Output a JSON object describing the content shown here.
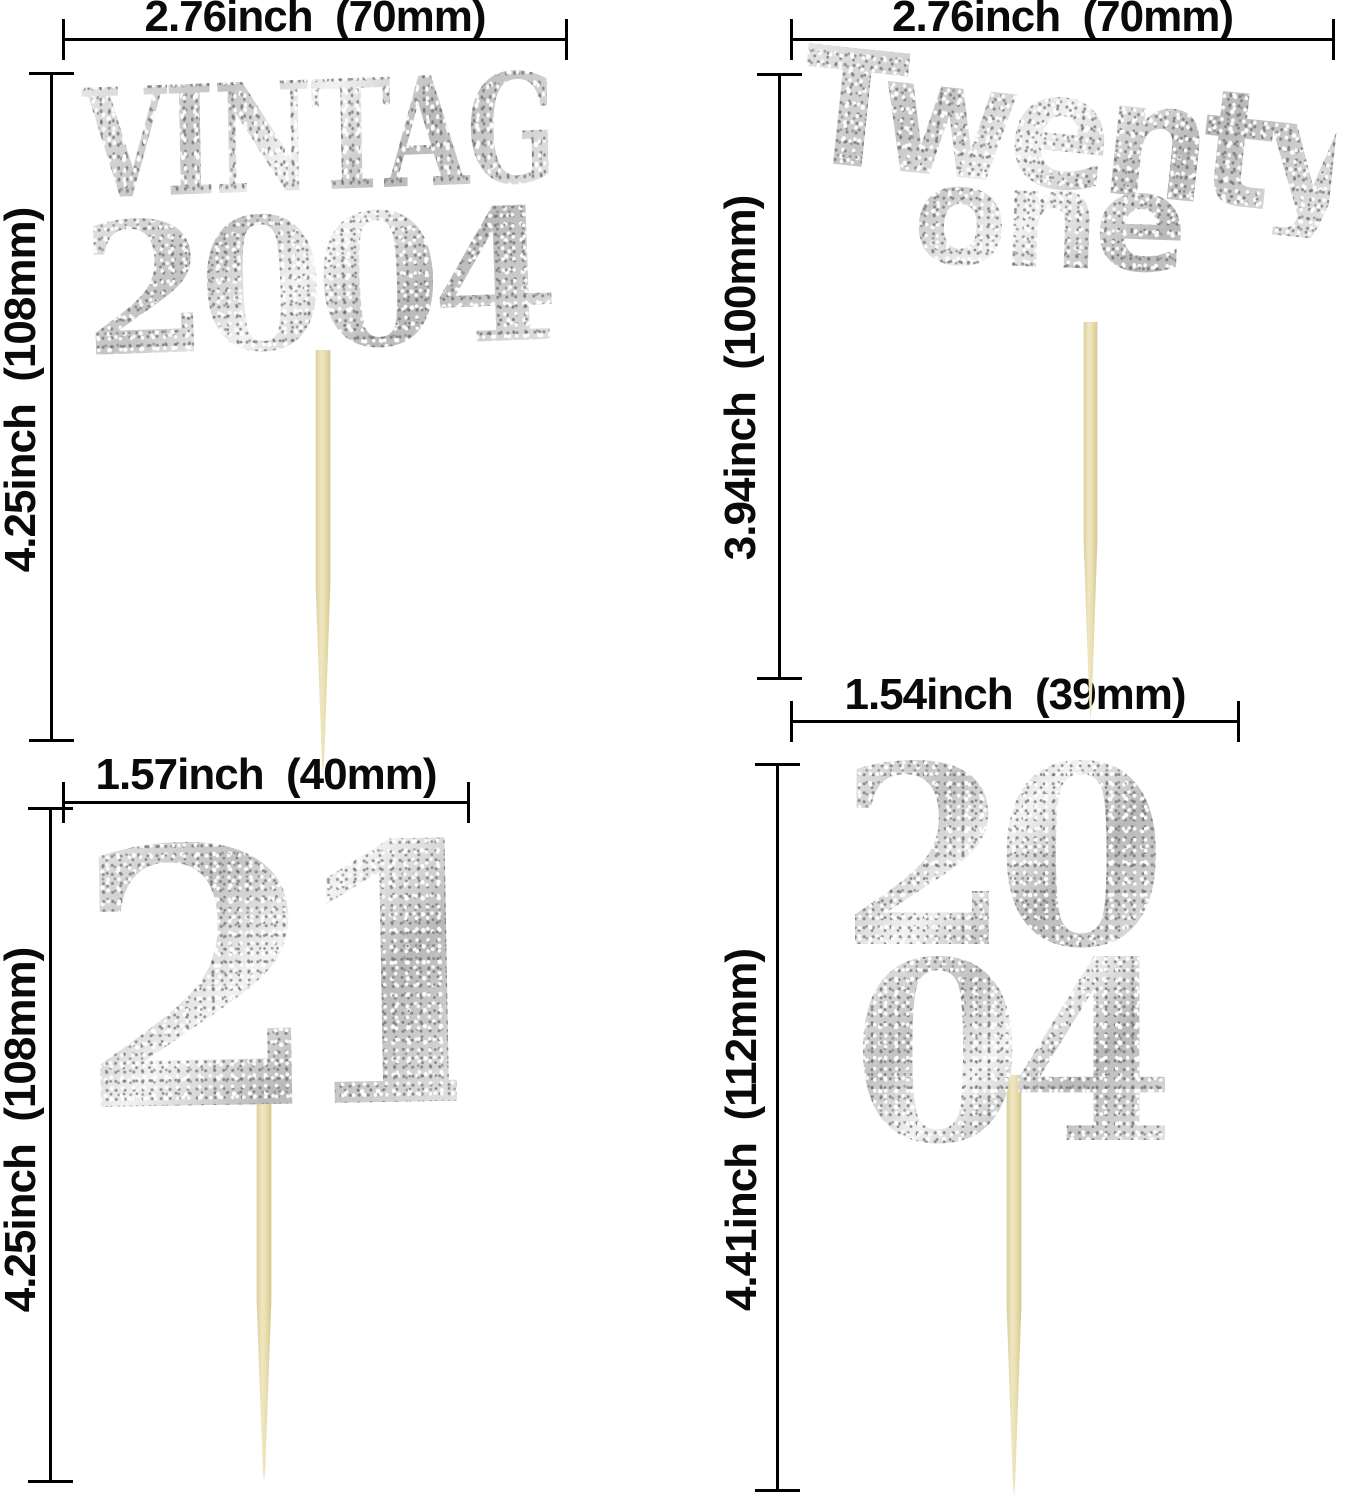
{
  "colors": {
    "background": "#ffffff",
    "dimension_line": "#000000",
    "glitter_silver": "#d9d9d9",
    "toothpick": "#e9dfb2"
  },
  "toppers": {
    "vintage": {
      "line1": "VINTAGE",
      "line2": "2004",
      "width_label": "2.76inch  (70mm)",
      "height_label": "4.25inch  (108mm)"
    },
    "twenty_one": {
      "line1": "Twenty",
      "line2": "one",
      "width_label": "2.76inch  (70mm)",
      "height_label": "3.94inch  (100mm)"
    },
    "number_21": {
      "line1": "21",
      "width_label": "1.57inch  (40mm)",
      "height_label": "4.25inch  (108mm)"
    },
    "year_2004_stacked": {
      "line1": "20",
      "line2": "04",
      "width_label": "1.54inch  (39mm)",
      "height_label": "4.41inch  (112mm)"
    }
  }
}
